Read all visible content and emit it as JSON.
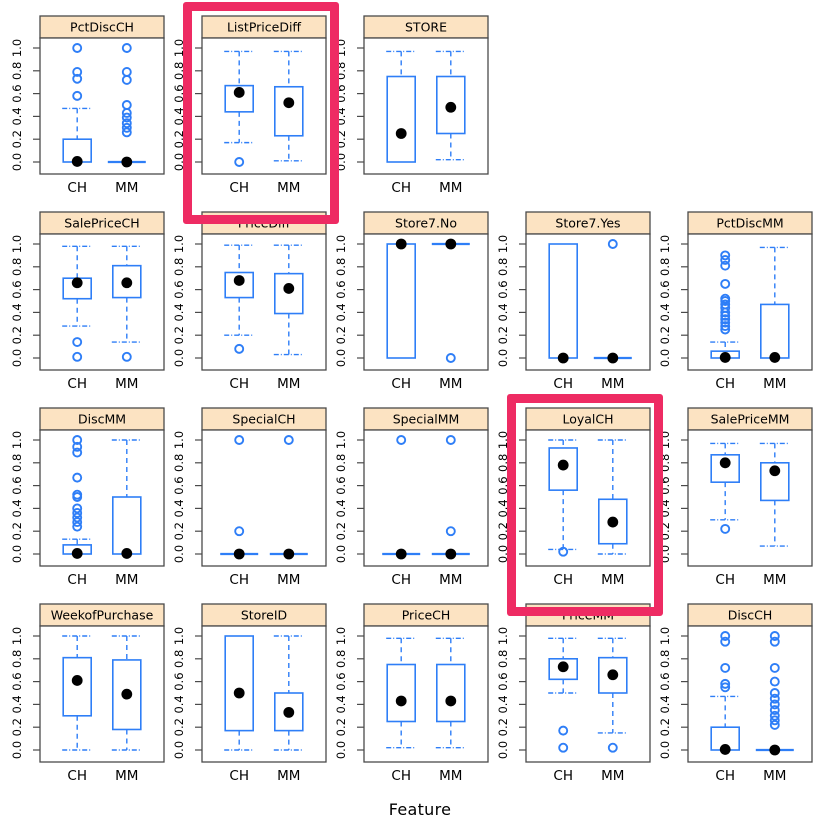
{
  "chart_data": {
    "type": "boxplot-grid",
    "title": "",
    "xlabel": "Feature",
    "group_labels": [
      "CH",
      "MM"
    ],
    "ylim": [
      0,
      1
    ],
    "yticks": [
      0.0,
      0.2,
      0.4,
      0.6,
      0.8,
      1.0
    ],
    "ytick_labels": [
      "0.0",
      "0.2",
      "0.4",
      "0.6",
      "0.8",
      "1.0"
    ],
    "legend": "none",
    "grid_lines": false,
    "colors": {
      "box_stroke": "#2e7ef7",
      "mean_dot": "#000000",
      "outlier_stroke": "#2e7ef7",
      "strip_bg": "#fce3c2",
      "panel_border": "#4a4a4a",
      "highlight": "#ee2b63",
      "text": "#000000",
      "background": "#ffffff"
    },
    "highlighted_panels": [
      "ListPriceDiff",
      "LoyalCH"
    ],
    "grid": [
      [
        {
          "name": "PctDiscCH",
          "hl": false,
          "g": [
            {
              "label": "CH",
              "lo": 0,
              "q1": 0,
              "q3": 0.2,
              "hi": 0.47,
              "m": 0.005,
              "out": [
                0.58,
                0.73,
                0.79,
                1.0
              ],
              "flat": false
            },
            {
              "label": "MM",
              "flat": true,
              "at": 0,
              "m": 0,
              "out": [
                0.26,
                0.3,
                0.34,
                0.39,
                0.43,
                0.5,
                0.72,
                0.79,
                1.0
              ]
            }
          ]
        },
        {
          "name": "ListPriceDiff",
          "hl": true,
          "g": [
            {
              "label": "CH",
              "lo": 0.17,
              "q1": 0.44,
              "q3": 0.67,
              "hi": 0.97,
              "m": 0.61,
              "out": [
                0.0
              ],
              "flat": false
            },
            {
              "label": "MM",
              "lo": 0.01,
              "q1": 0.23,
              "q3": 0.66,
              "hi": 0.97,
              "m": 0.52,
              "out": [],
              "flat": false
            }
          ]
        },
        {
          "name": "STORE",
          "hl": false,
          "g": [
            {
              "label": "CH",
              "lo": 0,
              "q1": 0,
              "q3": 0.75,
              "hi": 0.97,
              "m": 0.25,
              "out": [],
              "flat": false
            },
            {
              "label": "MM",
              "lo": 0.02,
              "q1": 0.25,
              "q3": 0.75,
              "hi": 0.97,
              "m": 0.48,
              "out": [],
              "flat": false
            }
          ]
        },
        null,
        null
      ],
      [
        {
          "name": "SalePriceCH",
          "hl": false,
          "g": [
            {
              "label": "CH",
              "lo": 0.28,
              "q1": 0.52,
              "q3": 0.7,
              "hi": 0.98,
              "m": 0.66,
              "out": [
                0.14,
                0.01
              ],
              "flat": false
            },
            {
              "label": "MM",
              "lo": 0.14,
              "q1": 0.53,
              "q3": 0.81,
              "hi": 0.98,
              "m": 0.66,
              "out": [
                0.01
              ],
              "flat": false
            }
          ]
        },
        {
          "name": "PriceDiff",
          "hl": false,
          "g": [
            {
              "label": "CH",
              "lo": 0.2,
              "q1": 0.53,
              "q3": 0.75,
              "hi": 0.99,
              "m": 0.68,
              "out": [
                0.08
              ],
              "flat": false
            },
            {
              "label": "MM",
              "lo": 0.03,
              "q1": 0.39,
              "q3": 0.74,
              "hi": 0.99,
              "m": 0.61,
              "out": [],
              "flat": false
            }
          ]
        },
        {
          "name": "Store7.No",
          "hl": false,
          "g": [
            {
              "label": "CH",
              "lo": 0,
              "q1": 0,
              "q3": 1.0,
              "hi": 1.0,
              "m": 1.0,
              "out": [],
              "flat": false
            },
            {
              "label": "MM",
              "flat": true,
              "at": 1.0,
              "m": 1.0,
              "out": [
                0.0
              ]
            }
          ]
        },
        {
          "name": "Store7.Yes",
          "hl": false,
          "g": [
            {
              "label": "CH",
              "lo": 0,
              "q1": 0,
              "q3": 1.0,
              "hi": 1.0,
              "m": 0.0,
              "out": [],
              "flat": false
            },
            {
              "label": "MM",
              "flat": true,
              "at": 0,
              "m": 0,
              "out": [
                1.0
              ]
            }
          ]
        },
        {
          "name": "PctDiscMM",
          "hl": false,
          "g": [
            {
              "label": "CH",
              "lo": 0,
              "q1": 0,
              "q3": 0.06,
              "hi": 0.14,
              "m": 0.005,
              "out": [
                0.25,
                0.28,
                0.31,
                0.34,
                0.37,
                0.4,
                0.44,
                0.47,
                0.5,
                0.52,
                0.65,
                0.81,
                0.86,
                0.9
              ],
              "flat": false
            },
            {
              "label": "MM",
              "lo": 0,
              "q1": 0,
              "q3": 0.47,
              "hi": 0.97,
              "m": 0.005,
              "out": [],
              "flat": false
            }
          ]
        }
      ],
      [
        {
          "name": "DiscMM",
          "hl": false,
          "g": [
            {
              "label": "CH",
              "lo": 0,
              "q1": 0,
              "q3": 0.08,
              "hi": 0.13,
              "m": 0.005,
              "out": [
                0.24,
                0.28,
                0.32,
                0.36,
                0.4,
                0.5,
                0.52,
                0.67,
                0.89,
                0.94,
                1.0
              ],
              "flat": false
            },
            {
              "label": "MM",
              "lo": 0,
              "q1": 0,
              "q3": 0.5,
              "hi": 1.0,
              "m": 0.005,
              "out": [],
              "flat": false
            }
          ]
        },
        {
          "name": "SpecialCH",
          "hl": false,
          "g": [
            {
              "label": "CH",
              "flat": true,
              "at": 0,
              "m": 0,
              "out": [
                0.2,
                1.0
              ]
            },
            {
              "label": "MM",
              "flat": true,
              "at": 0,
              "m": 0,
              "out": [
                1.0
              ]
            }
          ]
        },
        {
          "name": "SpecialMM",
          "hl": false,
          "g": [
            {
              "label": "CH",
              "flat": true,
              "at": 0,
              "m": 0,
              "out": [
                1.0
              ]
            },
            {
              "label": "MM",
              "flat": true,
              "at": 0,
              "m": 0,
              "out": [
                0.2,
                1.0
              ]
            }
          ]
        },
        {
          "name": "LoyalCH",
          "hl": true,
          "g": [
            {
              "label": "CH",
              "lo": 0.04,
              "q1": 0.56,
              "q3": 0.93,
              "hi": 1.0,
              "m": 0.78,
              "out": [
                0.02
              ],
              "flat": false
            },
            {
              "label": "MM",
              "lo": 0.0,
              "q1": 0.09,
              "q3": 0.48,
              "hi": 1.0,
              "m": 0.28,
              "out": [],
              "flat": false
            }
          ]
        },
        {
          "name": "SalePriceMM",
          "hl": false,
          "g": [
            {
              "label": "CH",
              "lo": 0.3,
              "q1": 0.63,
              "q3": 0.87,
              "hi": 0.97,
              "m": 0.8,
              "out": [
                0.22
              ],
              "flat": false
            },
            {
              "label": "MM",
              "lo": 0.07,
              "q1": 0.47,
              "q3": 0.8,
              "hi": 0.97,
              "m": 0.73,
              "out": [],
              "flat": false
            }
          ]
        }
      ],
      [
        {
          "name": "WeekofPurchase",
          "hl": false,
          "g": [
            {
              "label": "CH",
              "lo": 0,
              "q1": 0.3,
              "q3": 0.81,
              "hi": 1.0,
              "m": 0.61,
              "out": [],
              "flat": false
            },
            {
              "label": "MM",
              "lo": 0,
              "q1": 0.18,
              "q3": 0.79,
              "hi": 1.0,
              "m": 0.49,
              "out": [],
              "flat": false
            }
          ]
        },
        {
          "name": "StoreID",
          "hl": false,
          "g": [
            {
              "label": "CH",
              "lo": 0,
              "q1": 0.17,
              "q3": 1.0,
              "hi": 1.0,
              "m": 0.5,
              "out": [],
              "flat": false
            },
            {
              "label": "MM",
              "lo": 0,
              "q1": 0.17,
              "q3": 0.5,
              "hi": 1.0,
              "m": 0.33,
              "out": [],
              "flat": false
            }
          ]
        },
        {
          "name": "PriceCH",
          "hl": false,
          "g": [
            {
              "label": "CH",
              "lo": 0.02,
              "q1": 0.25,
              "q3": 0.75,
              "hi": 0.98,
              "m": 0.43,
              "out": [],
              "flat": false
            },
            {
              "label": "MM",
              "lo": 0.02,
              "q1": 0.25,
              "q3": 0.75,
              "hi": 0.98,
              "m": 0.43,
              "out": [],
              "flat": false
            }
          ]
        },
        {
          "name": "PriceMM",
          "hl": false,
          "g": [
            {
              "label": "CH",
              "lo": 0.5,
              "q1": 0.62,
              "q3": 0.8,
              "hi": 0.98,
              "m": 0.73,
              "out": [
                0.17,
                0.02
              ],
              "flat": false
            },
            {
              "label": "MM",
              "lo": 0.15,
              "q1": 0.5,
              "q3": 0.81,
              "hi": 0.98,
              "m": 0.66,
              "out": [
                0.02
              ],
              "flat": false
            }
          ]
        },
        {
          "name": "DiscCH",
          "hl": false,
          "g": [
            {
              "label": "CH",
              "lo": 0,
              "q1": 0,
              "q3": 0.2,
              "hi": 0.47,
              "m": 0.005,
              "out": [
                0.55,
                0.58,
                0.72,
                0.95,
                1.0
              ],
              "flat": false
            },
            {
              "label": "MM",
              "flat": true,
              "at": 0,
              "m": 0,
              "out": [
                0.22,
                0.26,
                0.3,
                0.35,
                0.4,
                0.45,
                0.5,
                0.6,
                0.72,
                0.95,
                1.0
              ]
            }
          ]
        }
      ]
    ]
  }
}
